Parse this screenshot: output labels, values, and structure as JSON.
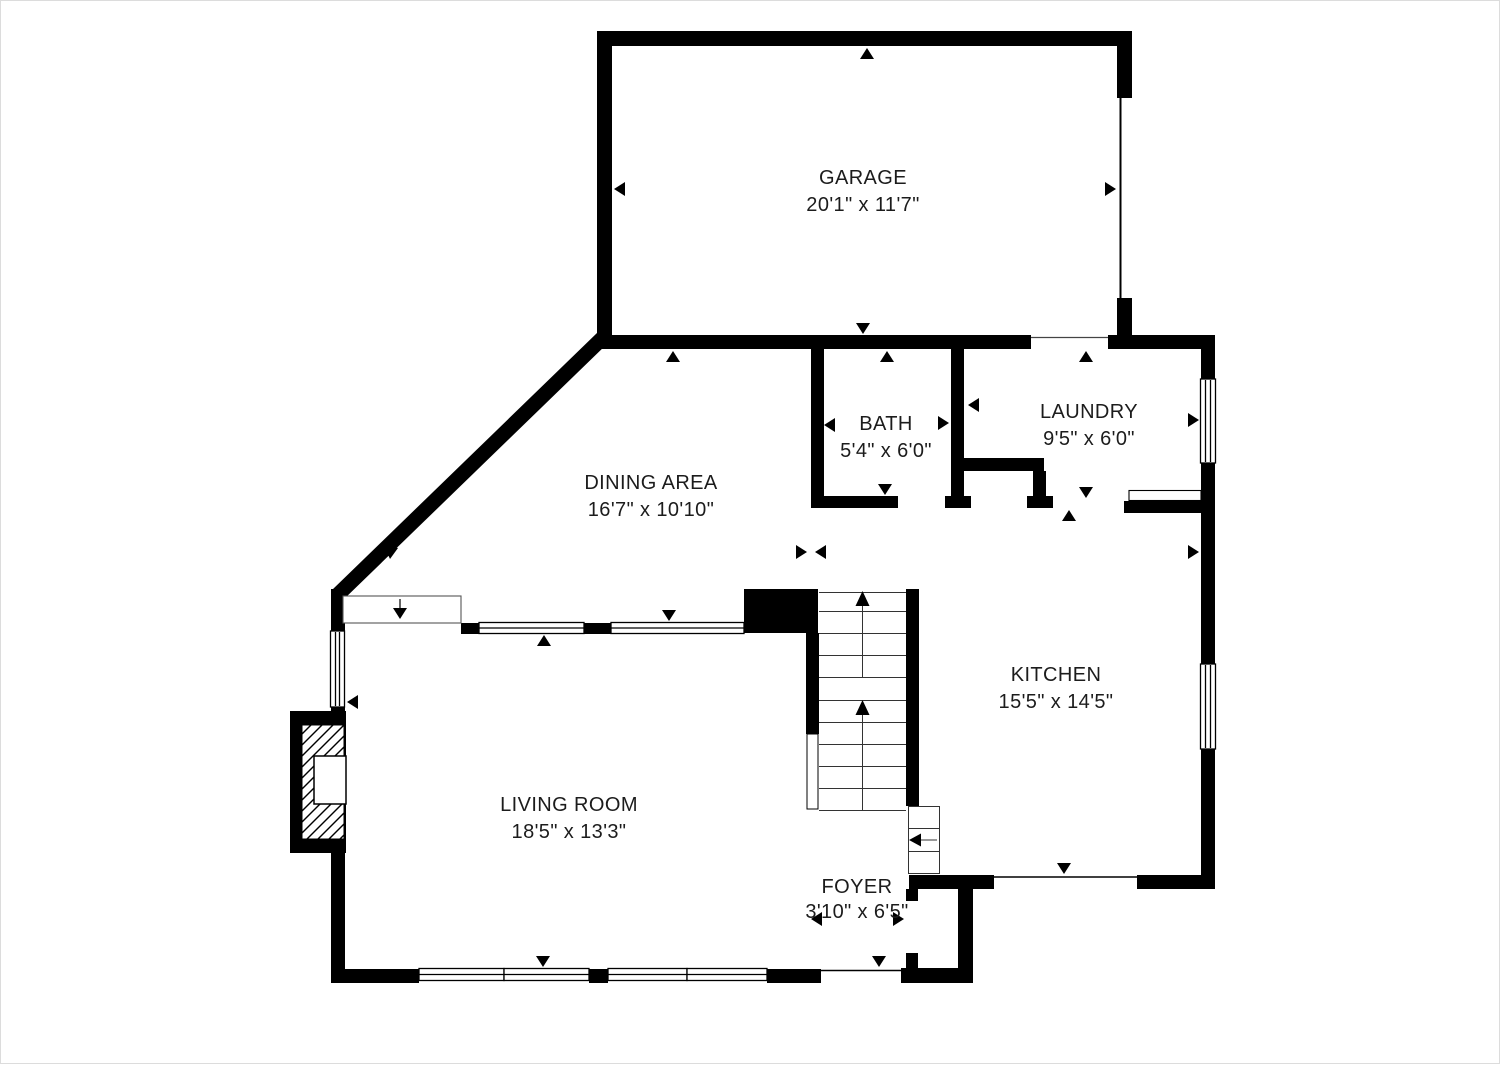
{
  "page": {
    "type": "floor-plan"
  },
  "rooms": {
    "garage": {
      "name": "GARAGE",
      "dims": "20'1\" x 11'7\""
    },
    "dining": {
      "name": "DINING AREA",
      "dims": "16'7\" x 10'10\""
    },
    "bath": {
      "name": "BATH",
      "dims": "5'4\" x 6'0\""
    },
    "laundry": {
      "name": "LAUNDRY",
      "dims": "9'5\" x 6'0\""
    },
    "kitchen": {
      "name": "KITCHEN",
      "dims": "15'5\" x 14'5\""
    },
    "living_room": {
      "name": "LIVING ROOM",
      "dims": "18'5\" x 13'3\""
    },
    "foyer": {
      "name": "FOYER",
      "dims": "3'10\" x 6'5\""
    }
  },
  "colors": {
    "wall": "#000000",
    "background": "#ffffff",
    "text": "#1c1c1c"
  }
}
